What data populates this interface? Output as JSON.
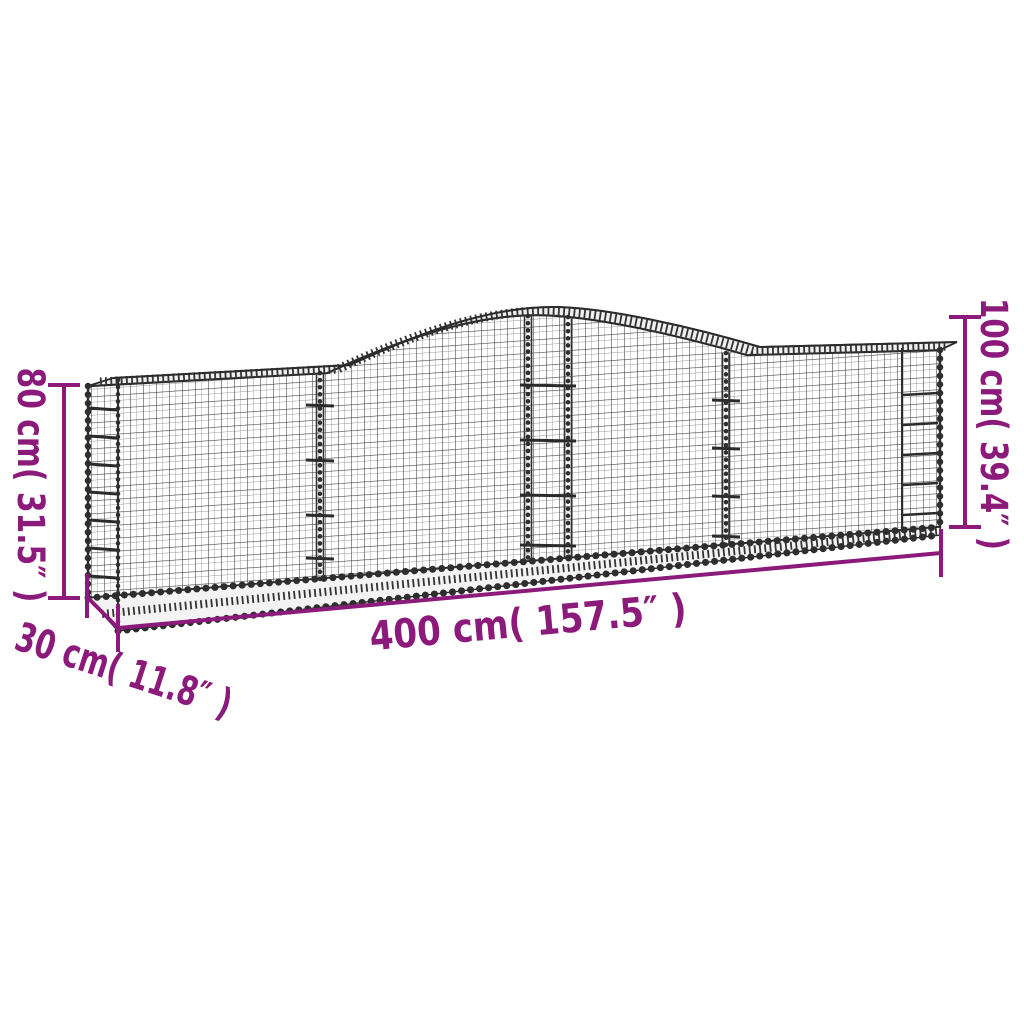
{
  "illustration": {
    "name": "arched-gabion-wire-mesh-basket",
    "wire_color": "#2E2E2E",
    "accent_color": "#8B1A7B",
    "background_color": "#FFFFFF"
  },
  "dimensions": {
    "height_left": "80 cm( 31.5″ )",
    "height_right": "100 cm( 39.4″ )",
    "width": "400 cm( 157.5″ )",
    "depth": "30 cm( 11.8″ )"
  }
}
